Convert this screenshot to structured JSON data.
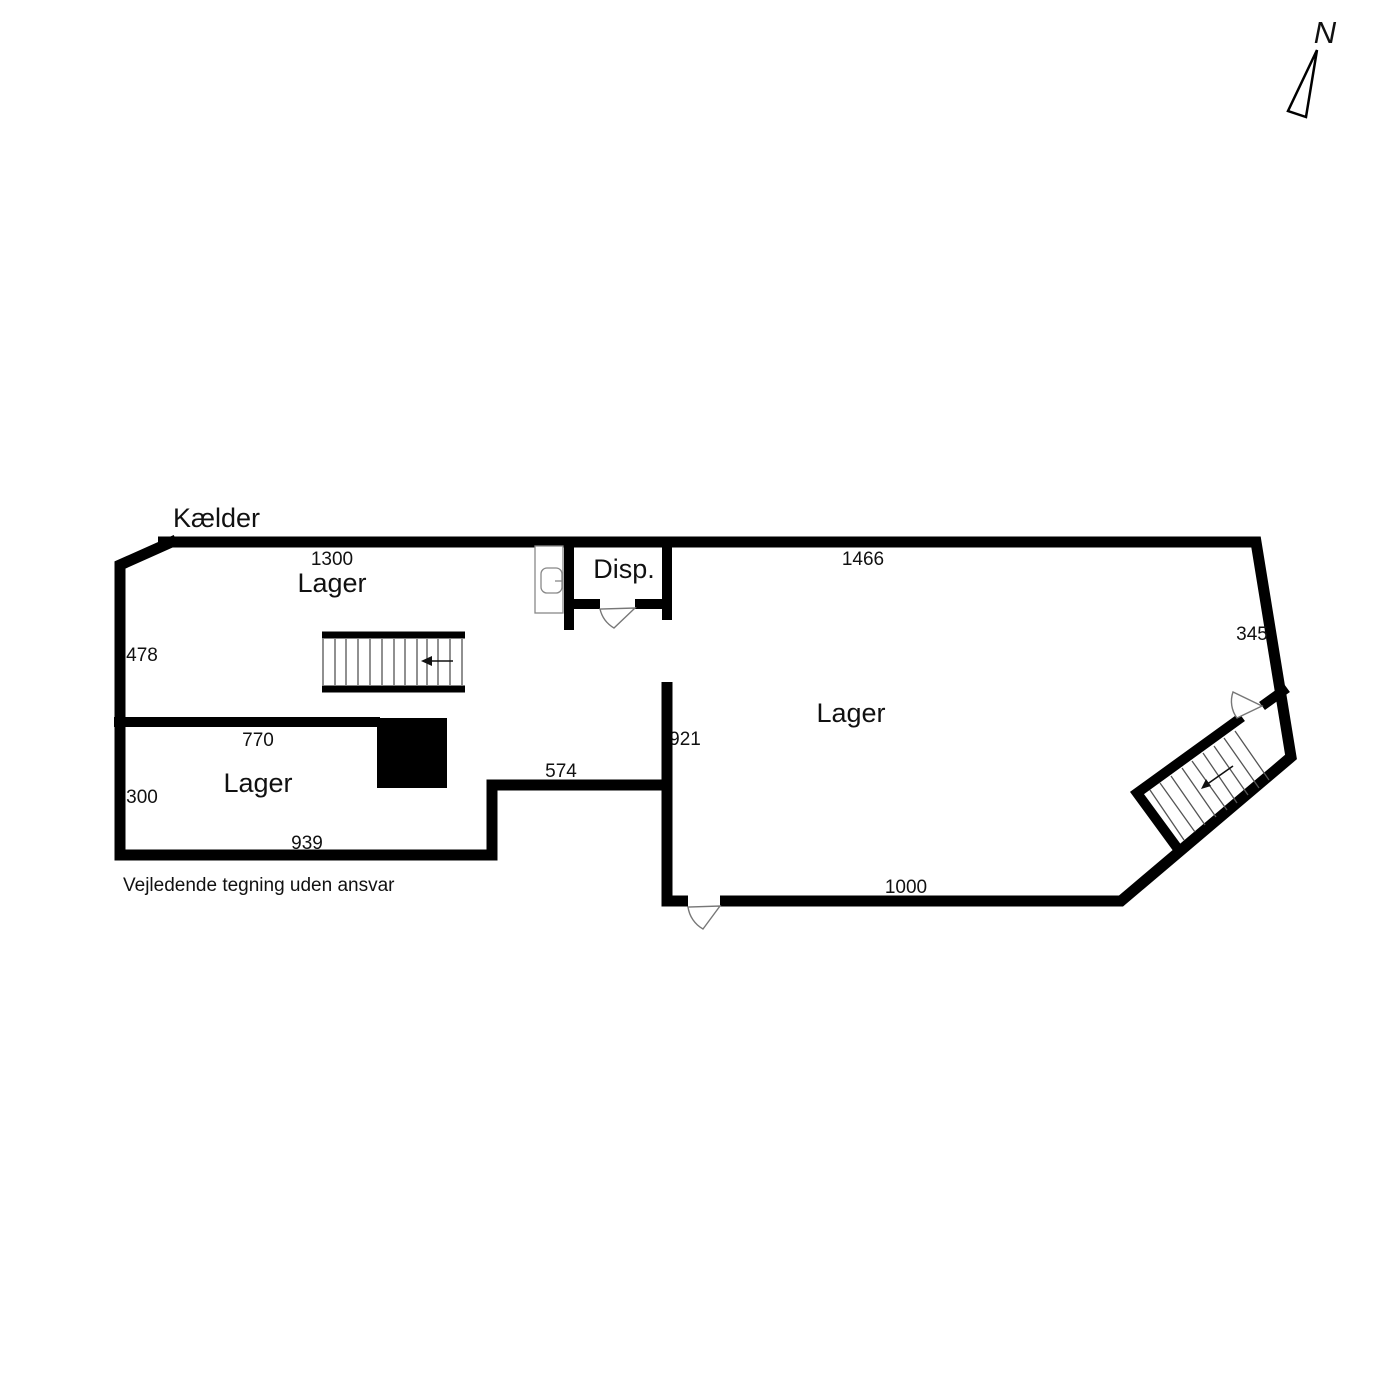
{
  "plan_title": "Kælder",
  "disclaimer": "Vejledende tegning uden ansvar",
  "compass": {
    "label": "N"
  },
  "rooms": {
    "lager_top": "Lager",
    "lager_left": "Lager",
    "lager_right": "Lager",
    "disp": "Disp."
  },
  "dimensions_cm": {
    "top_left_width": "1300",
    "top_right_width": "1466",
    "left_height": "478",
    "right_height": "345",
    "middle_height": "921",
    "passage_width": "574",
    "left_room_top_width": "770",
    "left_room_height": "300",
    "left_room_bottom_width": "939",
    "bottom_right_width": "1000"
  },
  "colors": {
    "walls": "#000000",
    "background": "#ffffff",
    "door_outline": "#777777",
    "fixture_outline": "#888888",
    "tread_lines": "#555555"
  }
}
